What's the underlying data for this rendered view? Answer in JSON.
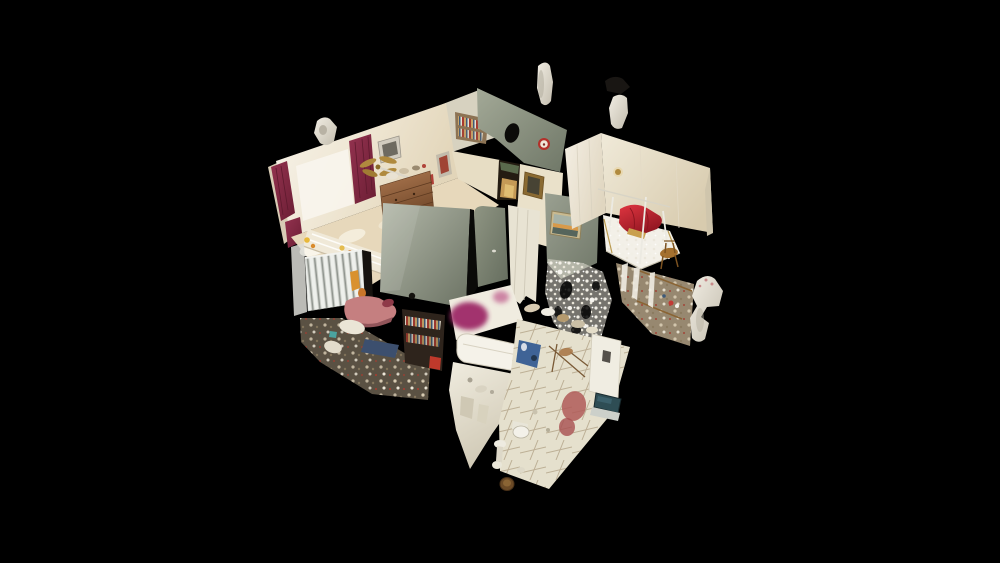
{
  "viewer": {
    "type": "3d-dollhouse-view",
    "description": "Photographic 3D dollhouse scan of a multi-room home interior seen from above at an angle, floating on a solid black background. No text, buttons or UI chrome are visible.",
    "background_color": "#000000"
  },
  "colors": {
    "background": "#000000",
    "wall_bright": "#f7f3ea",
    "wall_mid": "#eee5d1",
    "wall_shade": "#e2d5b9",
    "sage_light": "#a3a997",
    "sage_dark": "#6f7767",
    "panel_light": "#b4b9aa",
    "panel_dark": "#6b7263",
    "door_panel_light": "#8f9583",
    "door_panel_dark": "#656d5e",
    "curtain_light": "#93324f",
    "curtain_dark": "#6b1e34",
    "pillow_red_light": "#e03540",
    "pillow_red_dark": "#8e1520",
    "wood_light": "#ad7850",
    "wood_dark": "#6b4326",
    "tile_floor": "#e5e0cd",
    "tile_line": "#bdb096",
    "magenta_blur": "#9e2c68",
    "magenta_blur_2": "#b5407c",
    "laptop_teal": "#2e4d54",
    "radiator_white": "#eef0ec",
    "fragment_light": "#f1ede3",
    "fragment_dark": "#c3bdae",
    "brass_gold": "#b08a3e",
    "bath_wall_light": "#f0ecdf",
    "bath_wall_dark": "#cfc8b4"
  },
  "scene": {
    "model": "residential-interior-dollhouse",
    "rooms": [
      {
        "name": "bedroom-left",
        "features": [
          "maroon-curtains",
          "window-light",
          "wall-pictures",
          "brass-ceiling-fan",
          "wooden-dresser",
          "striped-bed",
          "sunlit-floor",
          "yellow-toys"
        ]
      },
      {
        "name": "back-room",
        "features": [
          "white-curtain",
          "bookshelf-with-books",
          "dark-oval-mirror-hole",
          "red-wall-clock",
          "sage-green-wall"
        ]
      },
      {
        "name": "hallway",
        "features": [
          "open-doorway-with-warm-light",
          "gold-framed-painting",
          "small-red-picture",
          "white-door-panels"
        ]
      },
      {
        "name": "bedroom-right",
        "features": [
          "canopy-bed-with-lace",
          "red-pillows",
          "gold-wall-sconce",
          "wooden-chair",
          "cluttered-vanity",
          "hanging-lace"
        ]
      },
      {
        "name": "bathroom",
        "features": [
          "bathtub",
          "diagonal-tiled-floor",
          "toilet",
          "pedestal-sink",
          "laptop-on-panel",
          "privacy-blur-magenta",
          "pink-towels"
        ]
      },
      {
        "name": "living-area",
        "features": [
          "white-radiator",
          "pink-sofa",
          "dark-bookshelf",
          "blue-rug",
          "floor-clutter",
          "grey-cut-wall-panels",
          "seascape-painting",
          "lace-point-cloud"
        ]
      }
    ],
    "artifacts": [
      "floating-scan-fragment-left",
      "floating-scan-fragment-top-center",
      "floating-scan-fragment-top-right-dark",
      "floating-scan-fragment-right"
    ]
  }
}
